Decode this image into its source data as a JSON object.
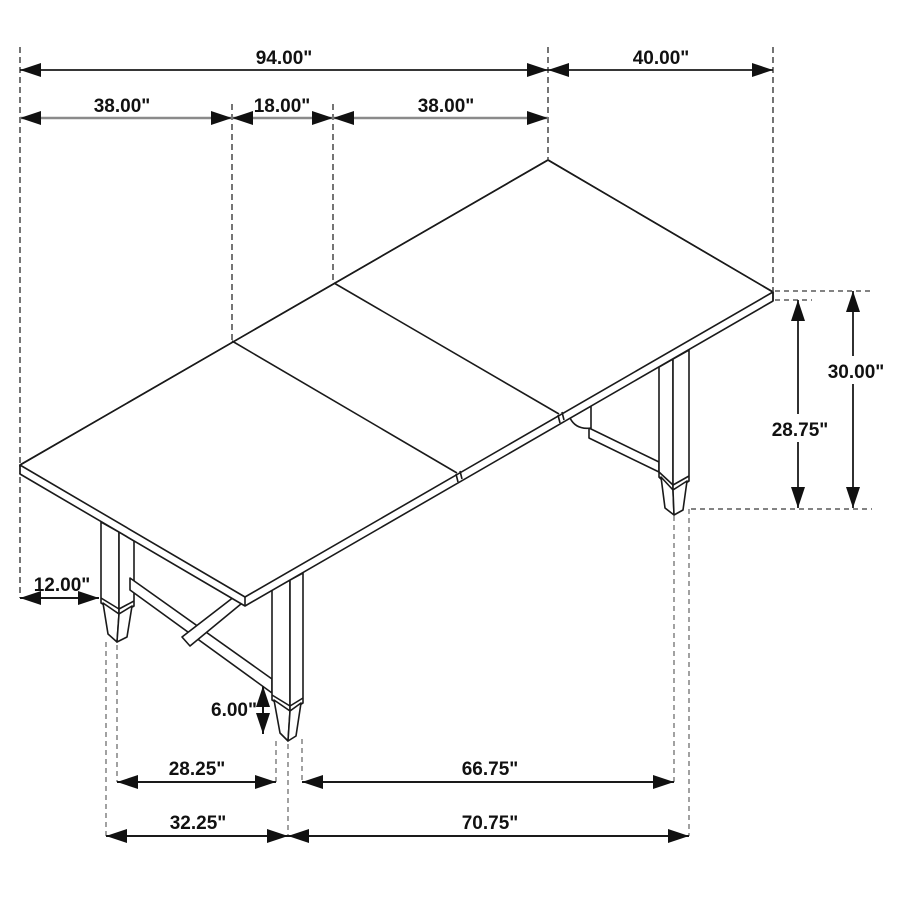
{
  "diagram": {
    "kind": "furniture-dimension-drawing",
    "subject": "extendable-trestle-dining-table",
    "background": "#ffffff",
    "line_color": "#1a1a1a",
    "secondary_line_color": "#8a8a8a",
    "text_color": "#111111",
    "unit_mark": "\""
  },
  "dimensions": {
    "overall_length": {
      "label": "94.00\"",
      "value": 94.0
    },
    "table_width": {
      "label": "40.00\"",
      "value": 40.0
    },
    "left_section": {
      "label": "38.00\"",
      "value": 38.0
    },
    "center_leaf": {
      "label": "18.00\"",
      "value": 18.0
    },
    "right_section": {
      "label": "38.00\"",
      "value": 38.0
    },
    "table_height": {
      "label": "30.00\"",
      "value": 30.0
    },
    "underside_height": {
      "label": "28.75\"",
      "value": 28.75
    },
    "leg_inset": {
      "label": "12.00\"",
      "value": 12.0
    },
    "foot_height": {
      "label": "6.00\"",
      "value": 6.0
    },
    "end_leg_spacing_inner": {
      "label": "28.25\"",
      "value": 28.25
    },
    "long_leg_spacing_inner": {
      "label": "66.75\"",
      "value": 66.75
    },
    "end_leg_spacing_outer": {
      "label": "32.25\"",
      "value": 32.25
    },
    "long_leg_spacing_outer": {
      "label": "70.75\"",
      "value": 70.75
    }
  }
}
